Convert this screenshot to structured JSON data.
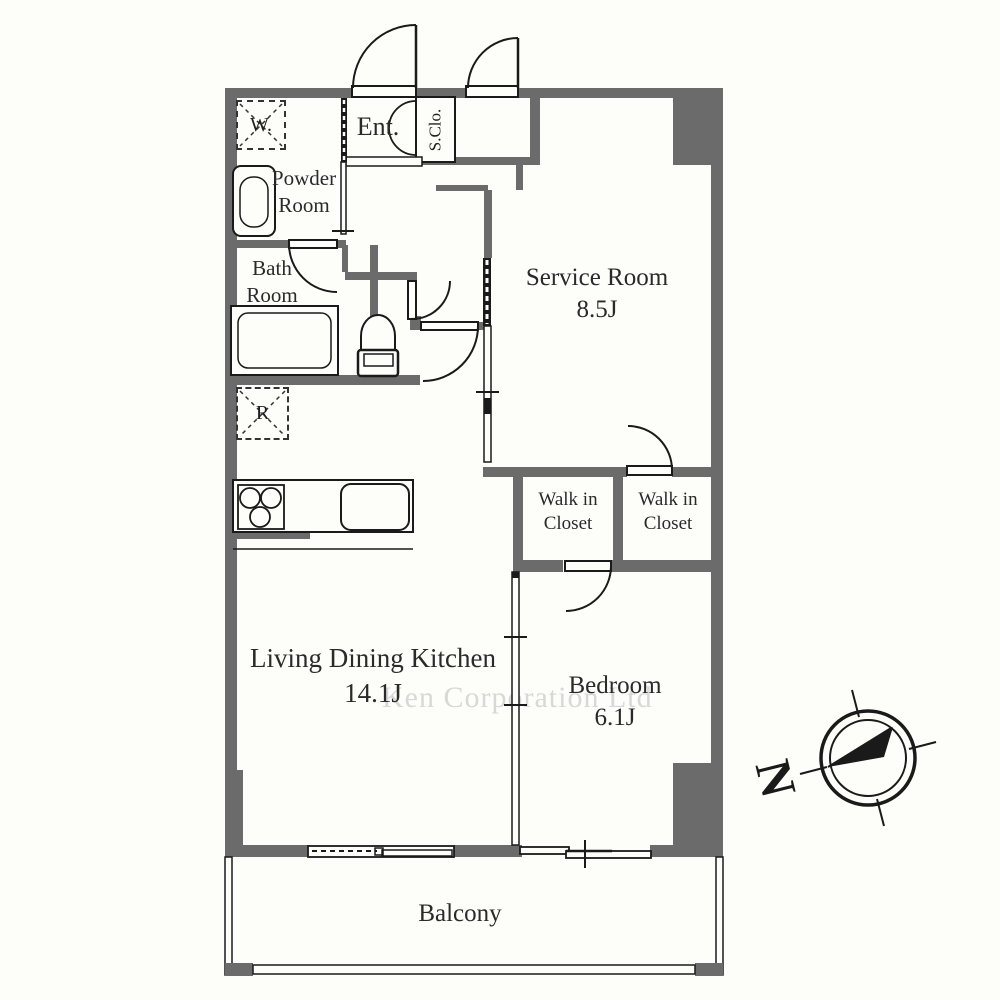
{
  "plan_title": "apartment-floor-plan",
  "rooms": {
    "entrance": {
      "label": "Ent."
    },
    "shoe_closet": {
      "label": "S.Clo."
    },
    "powder_room": {
      "label": "Powder Room"
    },
    "bath_room": {
      "label": "Bath Room"
    },
    "service_room": {
      "label": "Service Room",
      "area": "8.5J"
    },
    "walk_in_closet_left": {
      "label": "Walk in Closet"
    },
    "walk_in_closet_right": {
      "label": "Walk in Closet"
    },
    "living_dining_kitchen": {
      "label": "Living Dining Kitchen",
      "area": "14.1J"
    },
    "bedroom": {
      "label": "Bedroom",
      "area": "6.1J"
    },
    "balcony": {
      "label": "Balcony"
    }
  },
  "fixtures": {
    "washing_machine": "W.",
    "refrigerator": "R"
  },
  "compass": {
    "north_label": "N"
  },
  "watermark": {
    "text": "Ken Corporation Ltd"
  },
  "colors": {
    "wall": "#6b6b6b",
    "line": "#1a1a1a",
    "background": "#fdfdfa",
    "watermark": "#d8d8d8"
  }
}
